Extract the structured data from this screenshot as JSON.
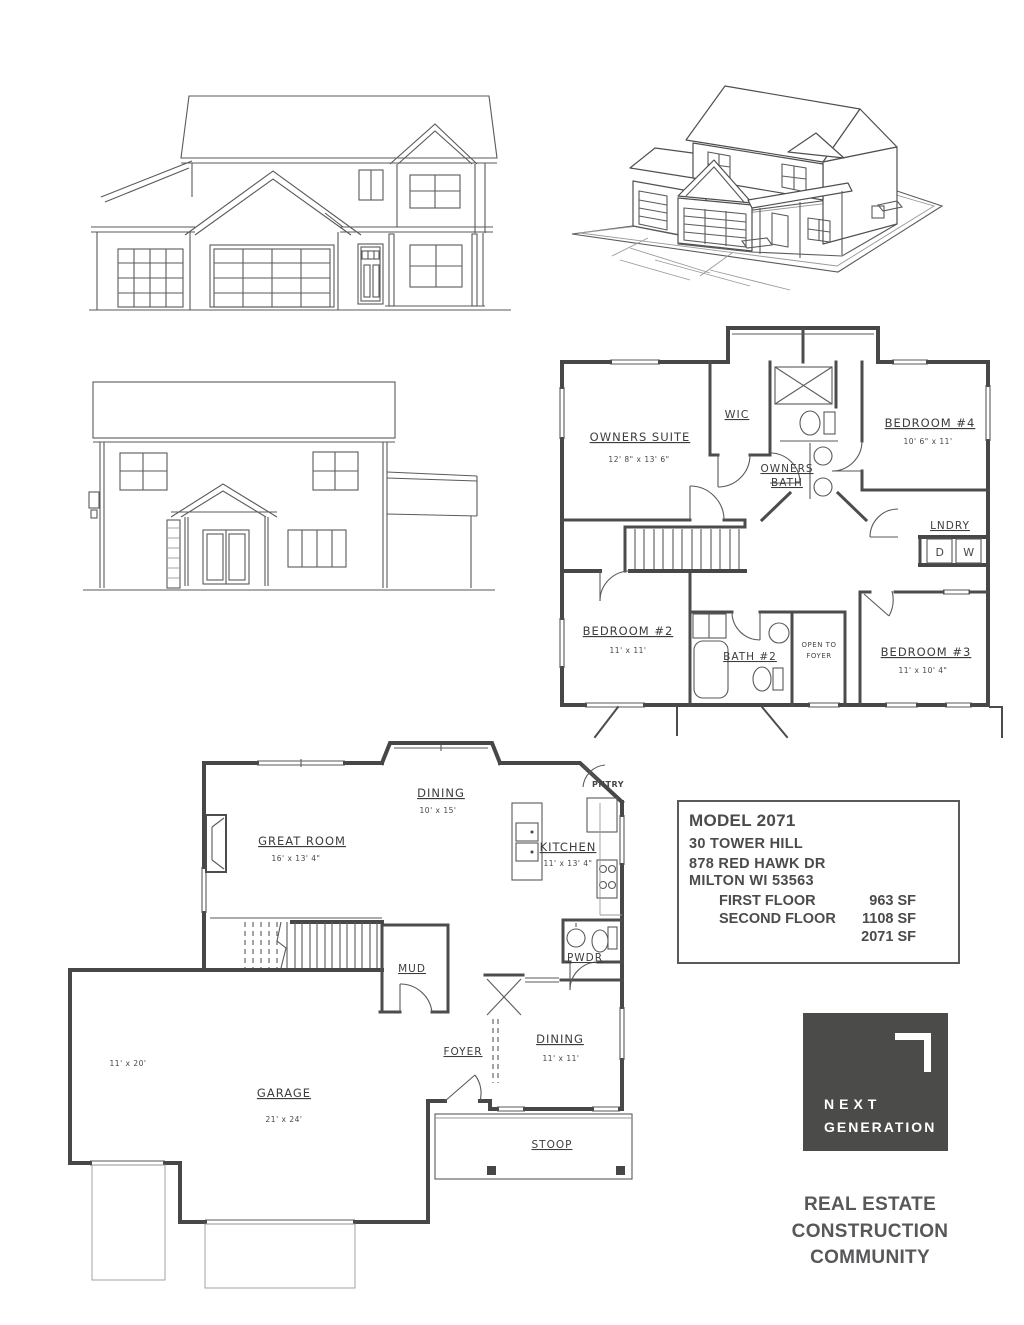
{
  "palette": {
    "ink": "#474747",
    "paper": "#ffffff",
    "logo_bg": "#4b4b49",
    "tagline_color": "#57585a"
  },
  "floor2": {
    "owners_suite": "OWNERS SUITE",
    "owners_suite_dims": "12' 8\" x 13' 6\"",
    "wic": "WIC",
    "owners_bath_l1": "OWNERS",
    "owners_bath_l2": "BATH",
    "bedroom4": "BEDROOM #4",
    "bedroom4_dims": "10' 6\" x 11'",
    "lndry": "LNDRY",
    "dryer": "D",
    "washer": "W",
    "bedroom2": "BEDROOM #2",
    "bedroom2_dims": "11' x 11'",
    "bath2": "BATH #2",
    "open_l1": "OPEN TO",
    "open_l2": "FOYER",
    "bedroom3": "BEDROOM #3",
    "bedroom3_dims": "11' x 10' 4\""
  },
  "floor1": {
    "dining": "DINING",
    "dining_dims": "10' x 15'",
    "great_room": "GREAT ROOM",
    "great_room_dims": "16' x 13' 4\"",
    "kitchen": "KITCHEN",
    "kitchen_dims": "11' x 13' 4\"",
    "pntry": "PNTRY",
    "mud": "MUD",
    "pwdr": "PWDR",
    "foyer": "FOYER",
    "dining2": "DINING",
    "dining2_dims": "11' x 11'",
    "garage": "GARAGE",
    "garage_dims": "21' x 24'",
    "garage_side_dims": "11' x 20'",
    "stoop": "STOOP"
  },
  "info": {
    "model": "MODEL 2071",
    "line2": "30 TOWER HILL",
    "line3": "878 RED HAWK DR",
    "line4": "MILTON WI  53563",
    "rows": [
      {
        "label": "FIRST FLOOR",
        "value": "963 SF"
      },
      {
        "label": "SECOND FLOOR",
        "value": "1108 SF"
      },
      {
        "label": "",
        "value": "2071 SF"
      }
    ]
  },
  "logo": {
    "l1": "NEXT",
    "l2": "GENERATION",
    "tag1": "REAL ESTATE",
    "tag2": "CONSTRUCTION",
    "tag3": "COMMUNITY"
  }
}
